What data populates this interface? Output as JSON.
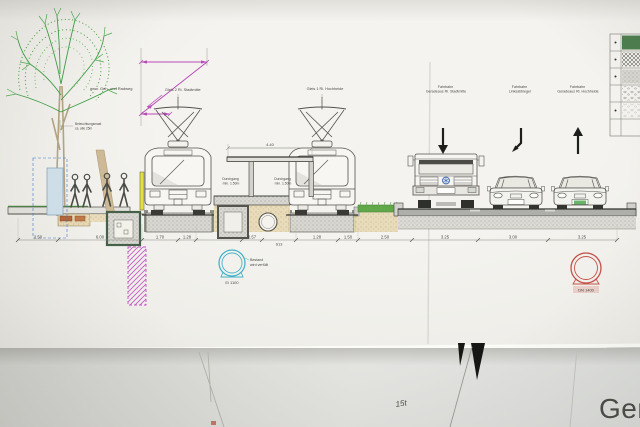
{
  "scene": {
    "background_title": "Gem",
    "handwritten_note": "15t"
  },
  "drawing": {
    "labels": {
      "footpath": "gem. Geh- und Radweg",
      "mast_l1": "Beleuchtungsmast",
      "mast_l2": "ca. alle 25m",
      "track_left": "Gleis 2 Ri. Stadtmitte",
      "track_right": "Gleis 1 Ri. Hochheide",
      "passage_l1": "Durchgang",
      "passage_l2": "min. 1.50m",
      "roof_span": "4.40",
      "station": "S13",
      "lanes": [
        {
          "line1": "Fahrbahn",
          "line2": "Geradeaus Ri. Stadtmitte",
          "arrow": "straight-ahead"
        },
        {
          "line1": "Fahrbahn",
          "line2": "Linksabbieger",
          "arrow": "left-turn"
        },
        {
          "line1": "Fahrbahn",
          "line2": "Geradeaus Ri. Hochheide",
          "arrow": "straight-ahead-up"
        }
      ],
      "sewer_existing": {
        "name": "Ei 1100",
        "note1": "Bestand",
        "note2": "wird verfüllt"
      },
      "sewer_new": {
        "name": "DN 1400"
      }
    },
    "dimensions": [
      "2.50",
      "6.00",
      "1.70",
      "1.28",
      "0.57",
      "1.28",
      "1.50",
      "2.50",
      "3.25",
      "3.00",
      "3.25"
    ],
    "legend_patterns": [
      "solid-green",
      "crosshatch",
      "stipple-dense",
      "stipple-sparse",
      "dots",
      "blank"
    ],
    "colors": {
      "tree_green": "#3f9f46",
      "magenta": "#b84cb8",
      "cyan": "#45b3c9",
      "red": "#c4534a",
      "yellow": "#e6e03c",
      "blue_title": "#45729f"
    }
  }
}
